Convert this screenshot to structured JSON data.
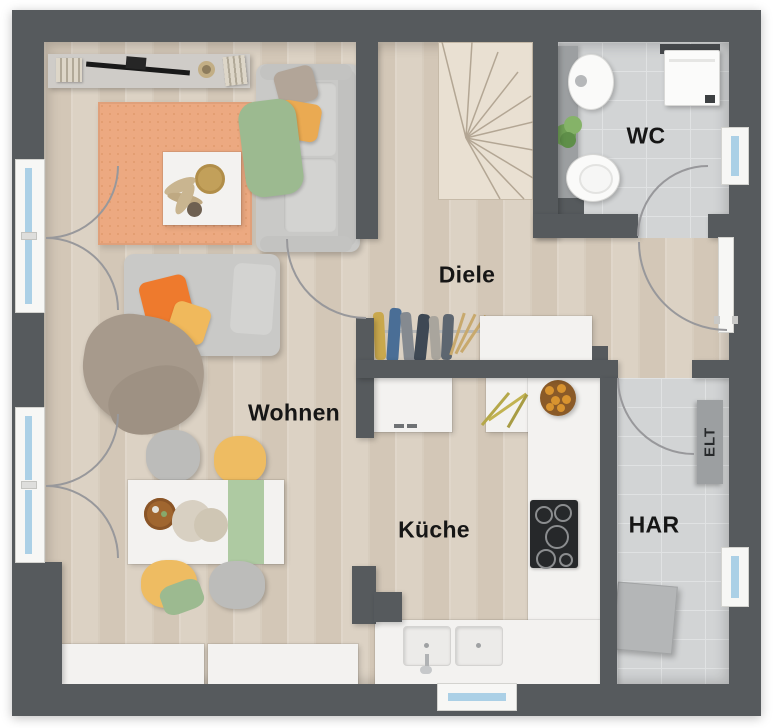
{
  "title": "Grundriss Erdgeschoss",
  "rooms": {
    "wohnen": {
      "label": "Wohnen"
    },
    "diele": {
      "label": "Diele"
    },
    "kueche": {
      "label": "Küche"
    },
    "wc": {
      "label": "WC"
    },
    "har": {
      "label": "HAR"
    },
    "elt": {
      "label": "ELT"
    }
  },
  "colors": {
    "wall": "#565a5d",
    "wood": "#dcd2c4",
    "wood_stripe": "#d3c7b7",
    "wood_light": "#e9e0d2",
    "tile": "#d2d4d5",
    "tile_line": "#e0e2e3",
    "counter": "#f3f2f0",
    "frame": "#f7f7f5",
    "glass": "#abd0e6",
    "arc": "#98989b",
    "label": "#161616",
    "sofa": "#c9c9c7",
    "sofa_light": "#d3d3d1",
    "rug": "#eca981",
    "rug_dot": "#e19b6f",
    "orange": "#ee7a2d",
    "mustard": "#eaaa52",
    "yellow": "#f0b95c",
    "green": "#9cba90",
    "taupe_blanket": "#a79a8c",
    "taupe_pillow": "#b2a598",
    "chair_gray": "#bcbcba",
    "chair_yellow": "#eebc62",
    "runner": "#aecaa2",
    "gray_fixture": "#9c9fa1",
    "appliance": "#b4b6b7",
    "cooktop": "#26282a",
    "bowl": "#a0662f",
    "fruit": "#d8932f",
    "plant": "#76a45c",
    "hanger": "#c8a96d",
    "dark_shelf": "#44474a"
  }
}
